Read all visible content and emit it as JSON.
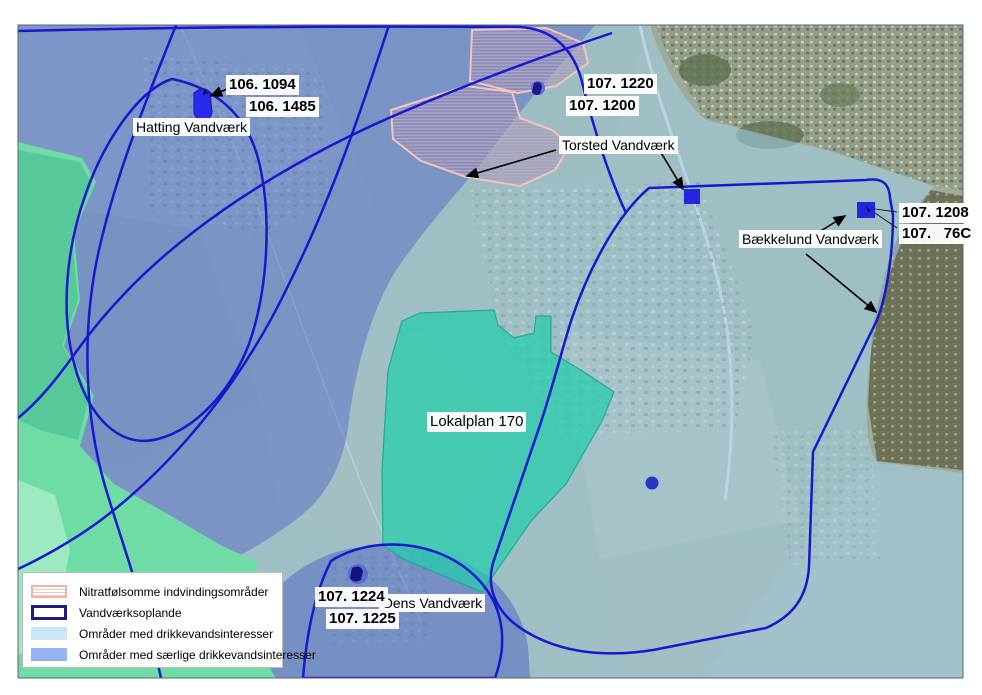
{
  "map_type": "groundwater-protection-map",
  "wells": [
    {
      "name": "Hatting Vandværk",
      "ids": [
        "106. 1094",
        "106. 1485"
      ]
    },
    {
      "name": "Torsted Vandværk",
      "ids": [
        "107. 1220",
        "107. 1200"
      ]
    },
    {
      "name": "Bækkelund Vandværk",
      "ids": [
        "107. 1208",
        "107.   76C"
      ]
    },
    {
      "name": "Oens Vandværk",
      "ids": [
        "107. 1224",
        "107. 1225"
      ]
    }
  ],
  "areas": {
    "lokalplan_label": "Lokalplan 170"
  },
  "legend": {
    "items": [
      {
        "label": "Nitratfølsomme indvindingsområder",
        "swatch": "pink-hatched-outline"
      },
      {
        "label": "Vandværksoplande",
        "swatch": "navy-outline"
      },
      {
        "label": "Områder med drikkevandsinteresser",
        "swatch": "light-blue-fill"
      },
      {
        "label": "Områder med særlige drikkevandsinteresser",
        "swatch": "medium-blue-fill"
      }
    ]
  },
  "colors": {
    "boundary_blue": "#1818d0",
    "legend_navy": "#1c1c82",
    "overlay_light_blue": "#cde6f6",
    "overlay_dark_blue": "#93b4ee",
    "nitrate_pink": "#efb3a8",
    "lokalplan_teal": "#25cdaa",
    "coast_green": "#6fdca6",
    "well_marker_blue": "#2525dd"
  }
}
